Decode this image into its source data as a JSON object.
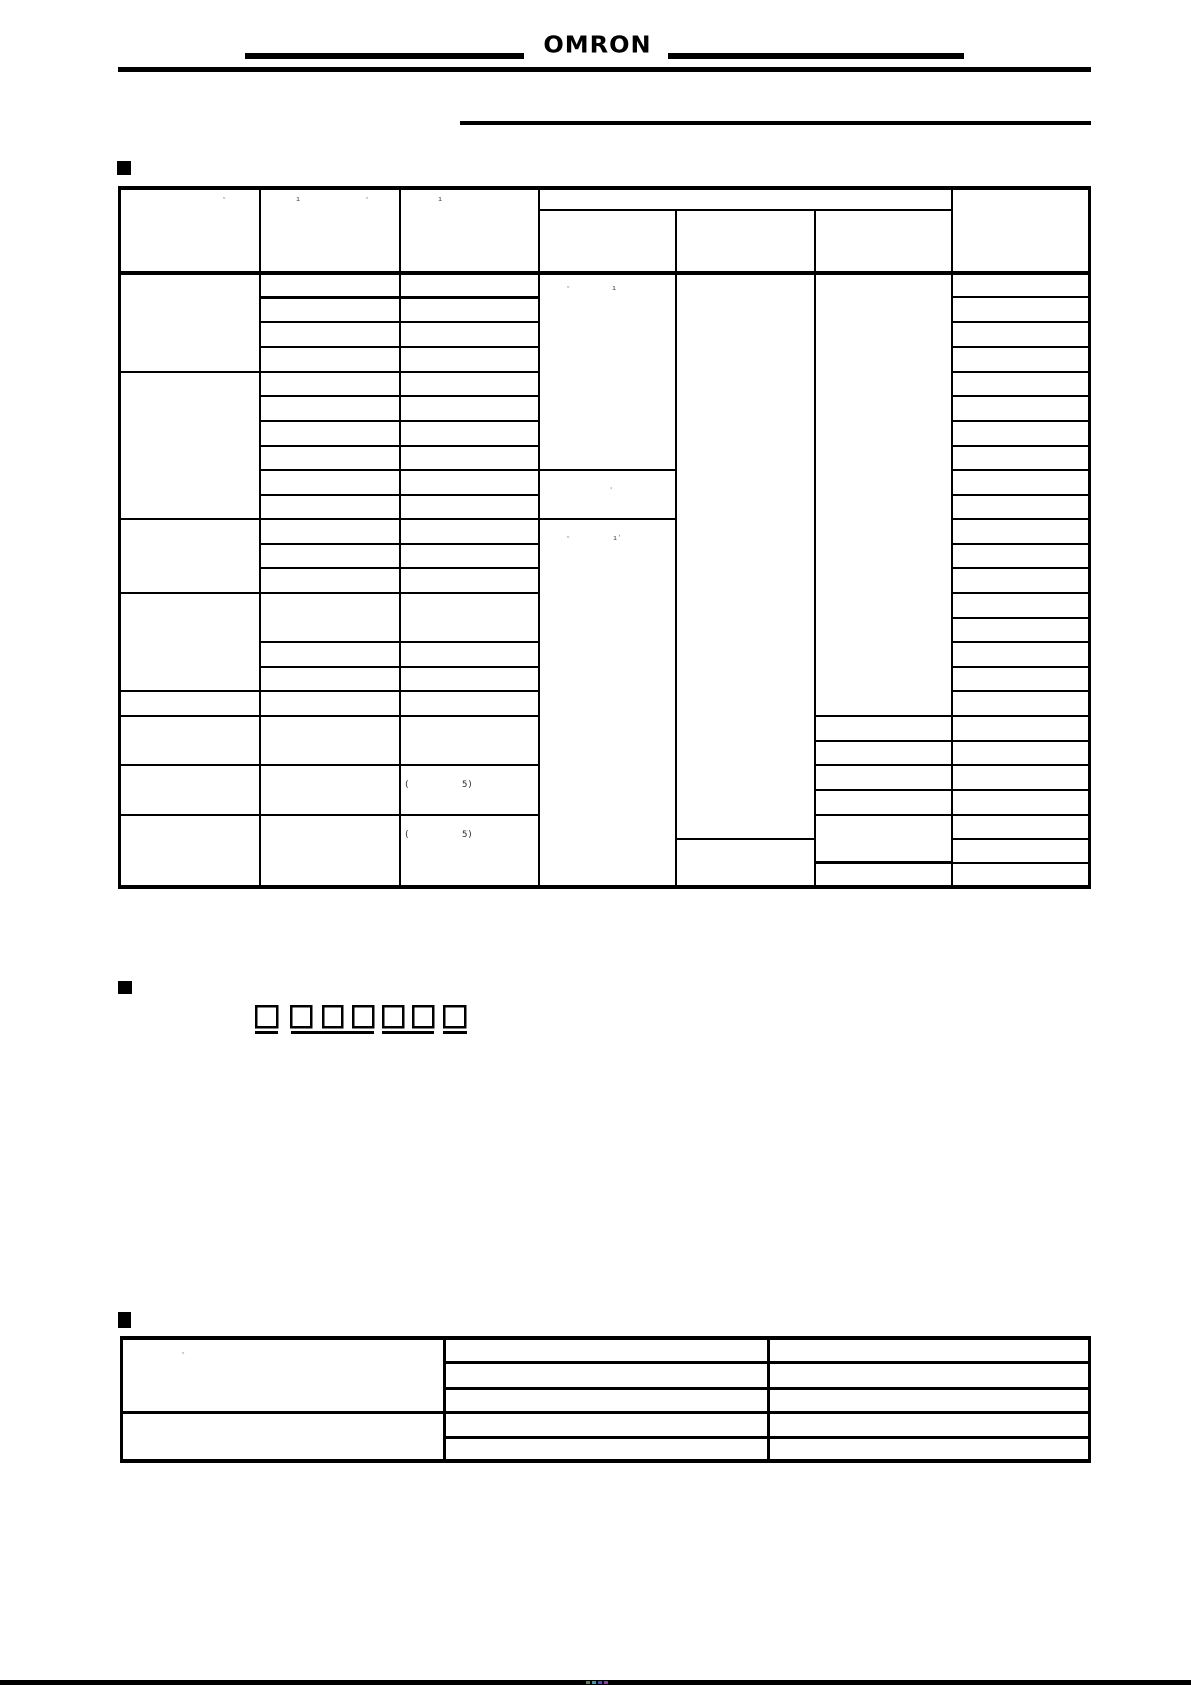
{
  "header": {
    "brand": "OMRON"
  },
  "sections": {
    "ordering_info": {
      "bullet_icon": "filled-square"
    },
    "model_number_legend": {
      "bullet_icon": "filled-square",
      "digit_boxes": 7,
      "digit_underline_groups": [
        1,
        3,
        2,
        1
      ]
    },
    "accessories": {
      "bullet_icon": "filled-square"
    }
  },
  "ordering_table": {
    "column_count": 7,
    "header_rows": 2,
    "merged_group_subcolumns": 3,
    "cell_text_legible": false
  },
  "accessories_table": {
    "column_count": 3,
    "row_count": 5,
    "cell_text_legible": false
  },
  "remnants": [
    {
      "glyph": "ᵕ"
    },
    {
      "glyph": "ı"
    },
    {
      "glyph": "ᵕ"
    },
    {
      "glyph": "ı"
    },
    {
      "glyph": "ᵕ"
    },
    {
      "glyph": "ı"
    },
    {
      "glyph": "ˌ"
    },
    {
      "glyph": "ᵕ"
    },
    {
      "glyph": "ıˈ"
    },
    {
      "glyph": "("
    },
    {
      "glyph": "5)"
    },
    {
      "glyph": "("
    },
    {
      "glyph": "5)"
    },
    {
      "glyph": "ᵕ"
    }
  ],
  "footer": {
    "bar_color": "#000000",
    "registration_marks": [
      "#4a8f3c",
      "#2fa0a0",
      "#3b4fd8",
      "#8a3fae"
    ]
  }
}
